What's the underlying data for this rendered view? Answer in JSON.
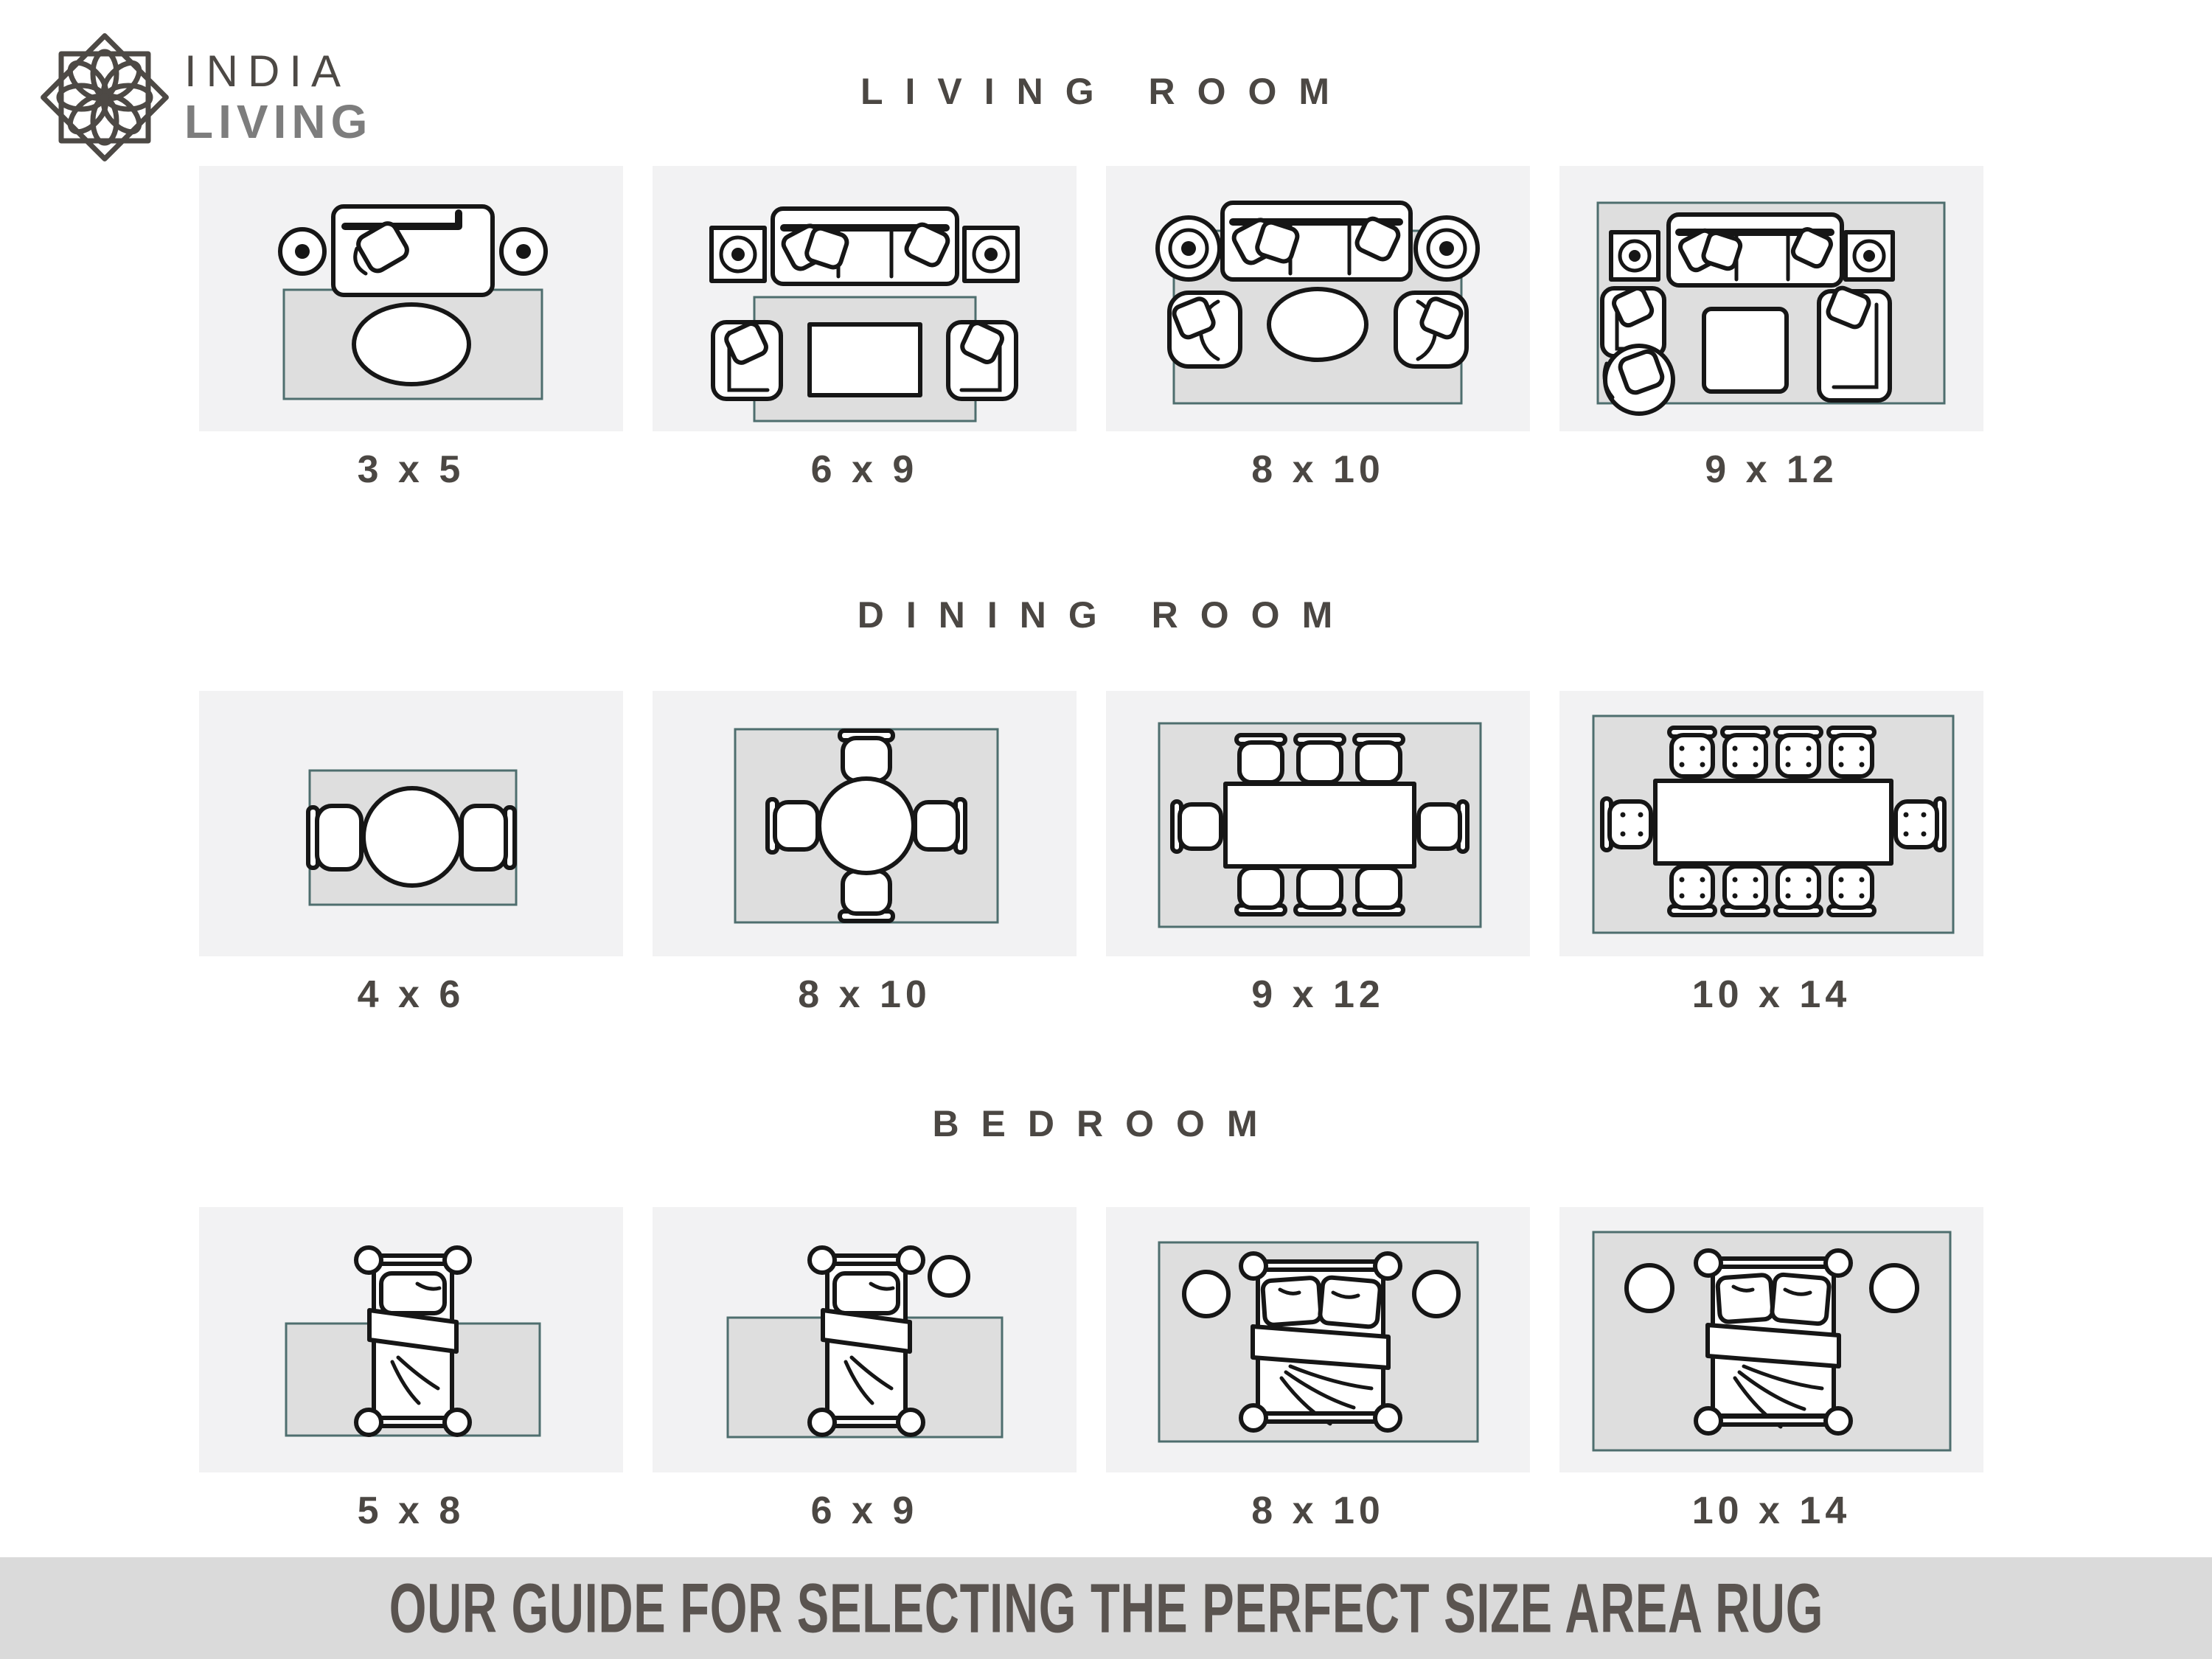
{
  "logo": {
    "brand_top": "INDIA",
    "brand_bottom": "LIVING"
  },
  "sections": [
    {
      "title": "LIVING ROOM",
      "cards": [
        {
          "size": "3 x 5",
          "layout": "loveseat, two round side tables, oval coffee table on small rug"
        },
        {
          "size": "6 x 9",
          "layout": "sofa, two square side tables, rectangular coffee table, two armchairs front legs on rug"
        },
        {
          "size": "8 x 10",
          "layout": "sofa, two round side tables, oval coffee table, two armchairs on rug"
        },
        {
          "size": "9 x 12",
          "layout": "all furniture fully on rug: sofa, side tables, square coffee table, armchair, round chair, chaise"
        }
      ]
    },
    {
      "title": "DINING ROOM",
      "cards": [
        {
          "size": "4 x 6",
          "layout": "round table with two chairs"
        },
        {
          "size": "8 x 10",
          "layout": "round table with four chairs"
        },
        {
          "size": "9 x 12",
          "layout": "rectangular table with eight chairs"
        },
        {
          "size": "10 x 14",
          "layout": "rectangular table with ten chairs"
        }
      ]
    },
    {
      "title": "BEDROOM",
      "cards": [
        {
          "size": "5 x 8",
          "layout": "twin bed, rug under lower two-thirds"
        },
        {
          "size": "6 x 9",
          "layout": "twin bed with round side table, rug under lower two-thirds"
        },
        {
          "size": "8 x 10",
          "layout": "queen bed and two round nightstands fully on rug"
        },
        {
          "size": "10 x 14",
          "layout": "king bed and two round nightstands fully on rug"
        }
      ]
    }
  ],
  "footer": {
    "text": "OUR GUIDE FOR SELECTING THE PERFECT SIZE AREA RUG"
  },
  "colors": {
    "card_background": "#f2f2f3",
    "rug_fill": "#dedede",
    "rug_border": "#4e6e6e",
    "furniture_outline": "#161616",
    "title_text": "#4b4743",
    "footer_background": "#dadada",
    "footer_text": "#5a5450",
    "logo_dark": "#4d4945",
    "logo_gray": "#7d7d7d"
  }
}
